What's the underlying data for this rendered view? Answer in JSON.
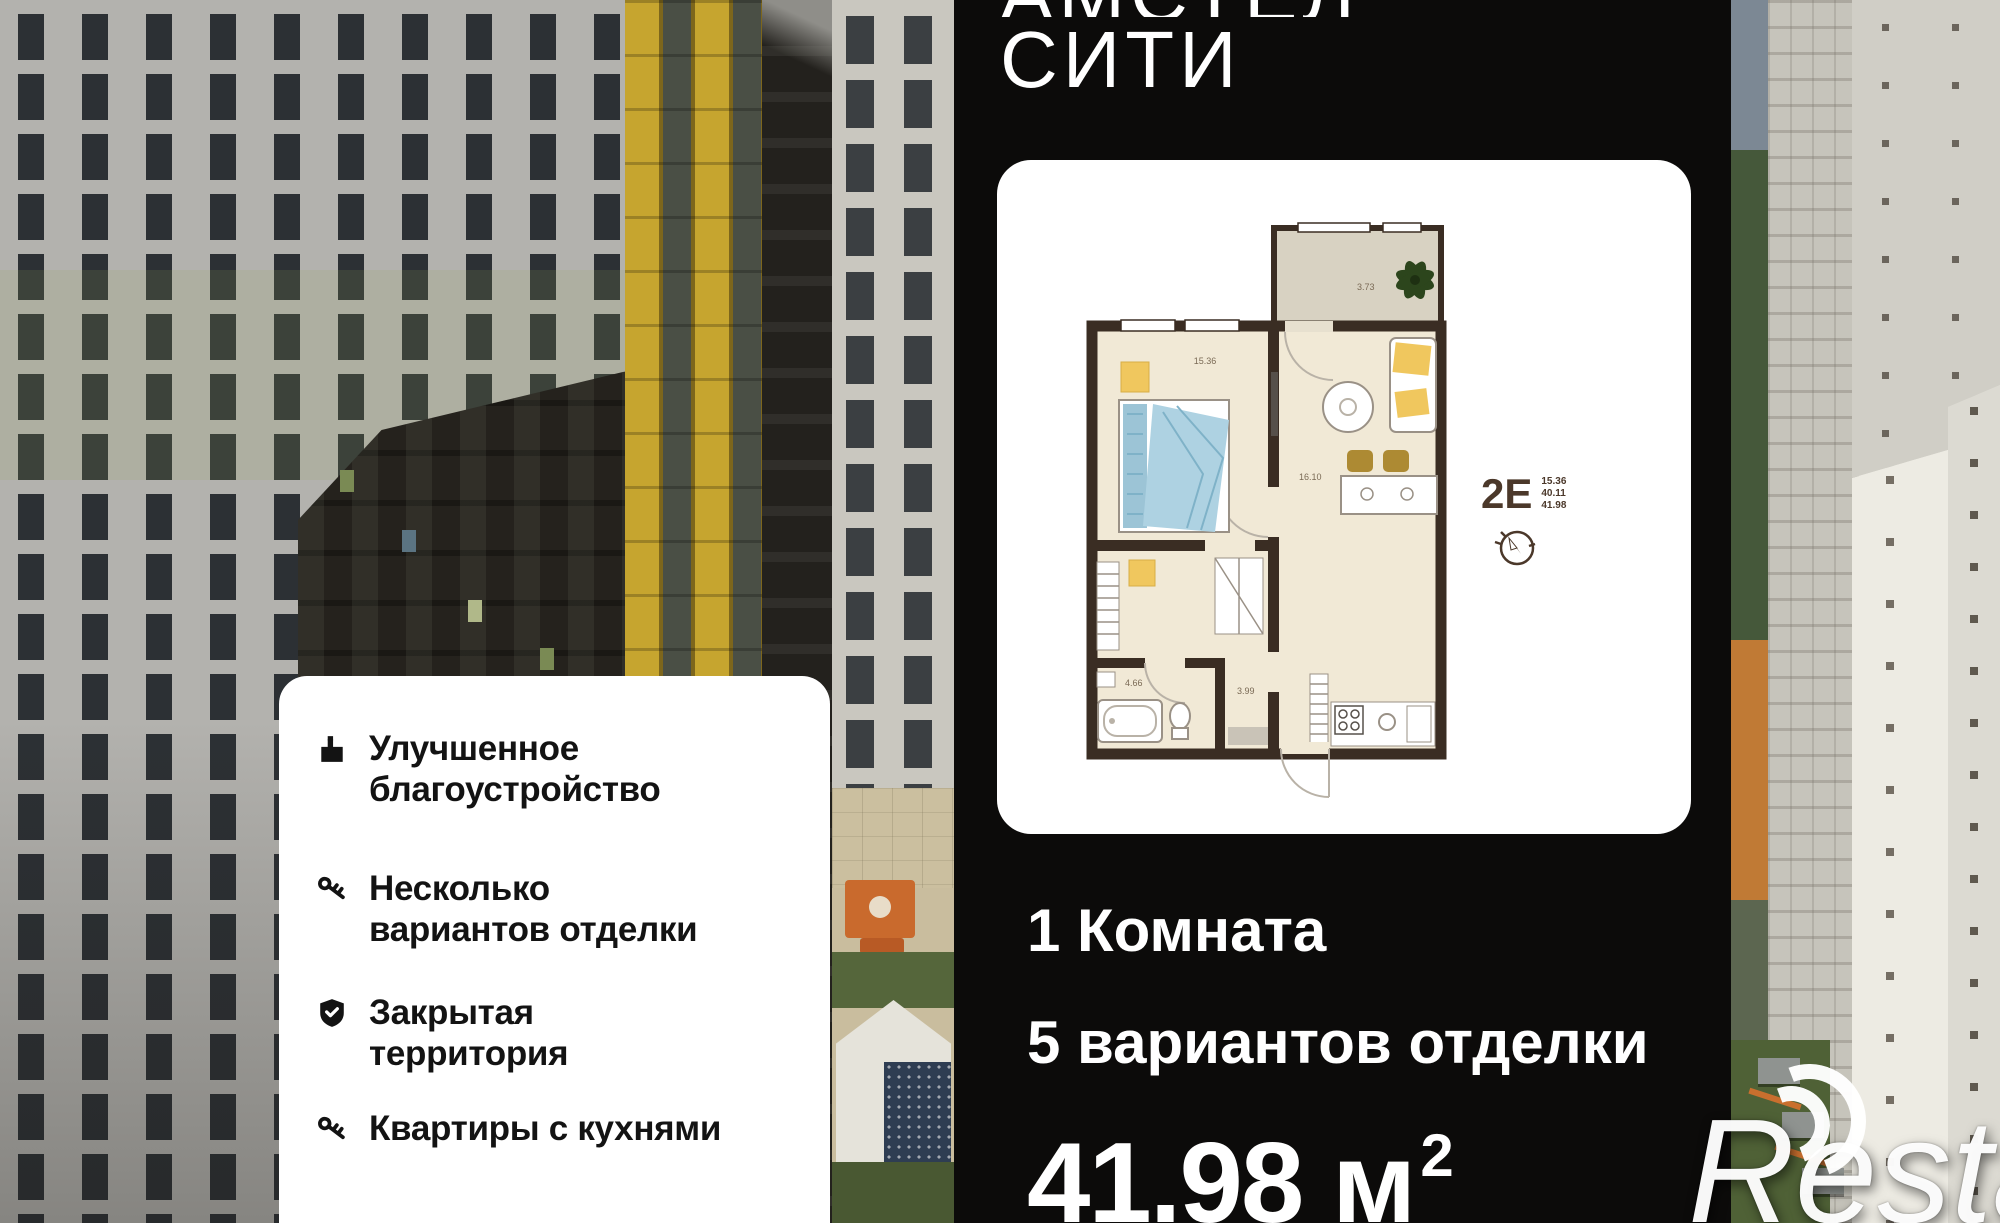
{
  "header": {
    "title_line1_partial": "АМСТЕЛ",
    "title_line2": "СИТИ"
  },
  "plan": {
    "type_label": "2Е",
    "area_lines": [
      "15.36",
      "40.11",
      "41.98"
    ],
    "rooms": {
      "bedroom": "15.36",
      "balcony": "3.73",
      "living": "16.10",
      "bathroom": "4.66",
      "hall": "3.99"
    }
  },
  "summary": {
    "rooms_line": "1 Комната",
    "finishes_line": "5 вариантов отделки",
    "area_value": "41.98",
    "area_unit": "м",
    "area_sup": "2"
  },
  "features": {
    "items": [
      {
        "icon": "landscaping-icon",
        "line1": "Улучшенное",
        "line2": "благоустройство"
      },
      {
        "icon": "key-icon",
        "line1": "Несколько",
        "line2": "вариантов отделки"
      },
      {
        "icon": "shield-check-icon",
        "line1": "Закрытая",
        "line2": "территория"
      },
      {
        "icon": "key-icon",
        "line1": "Квартиры с кухнями",
        "line2": ""
      }
    ]
  },
  "watermark": {
    "initial": "R",
    "rest": "estate"
  },
  "colors": {
    "panel": "#0c0b0a",
    "accent_yellow": "#c6a52f",
    "plan_wall": "#3a2d23",
    "plan_floor": "#f1e9d6",
    "bed_blue": "#a9cfdf",
    "accent_orange": "#c96a2d"
  }
}
